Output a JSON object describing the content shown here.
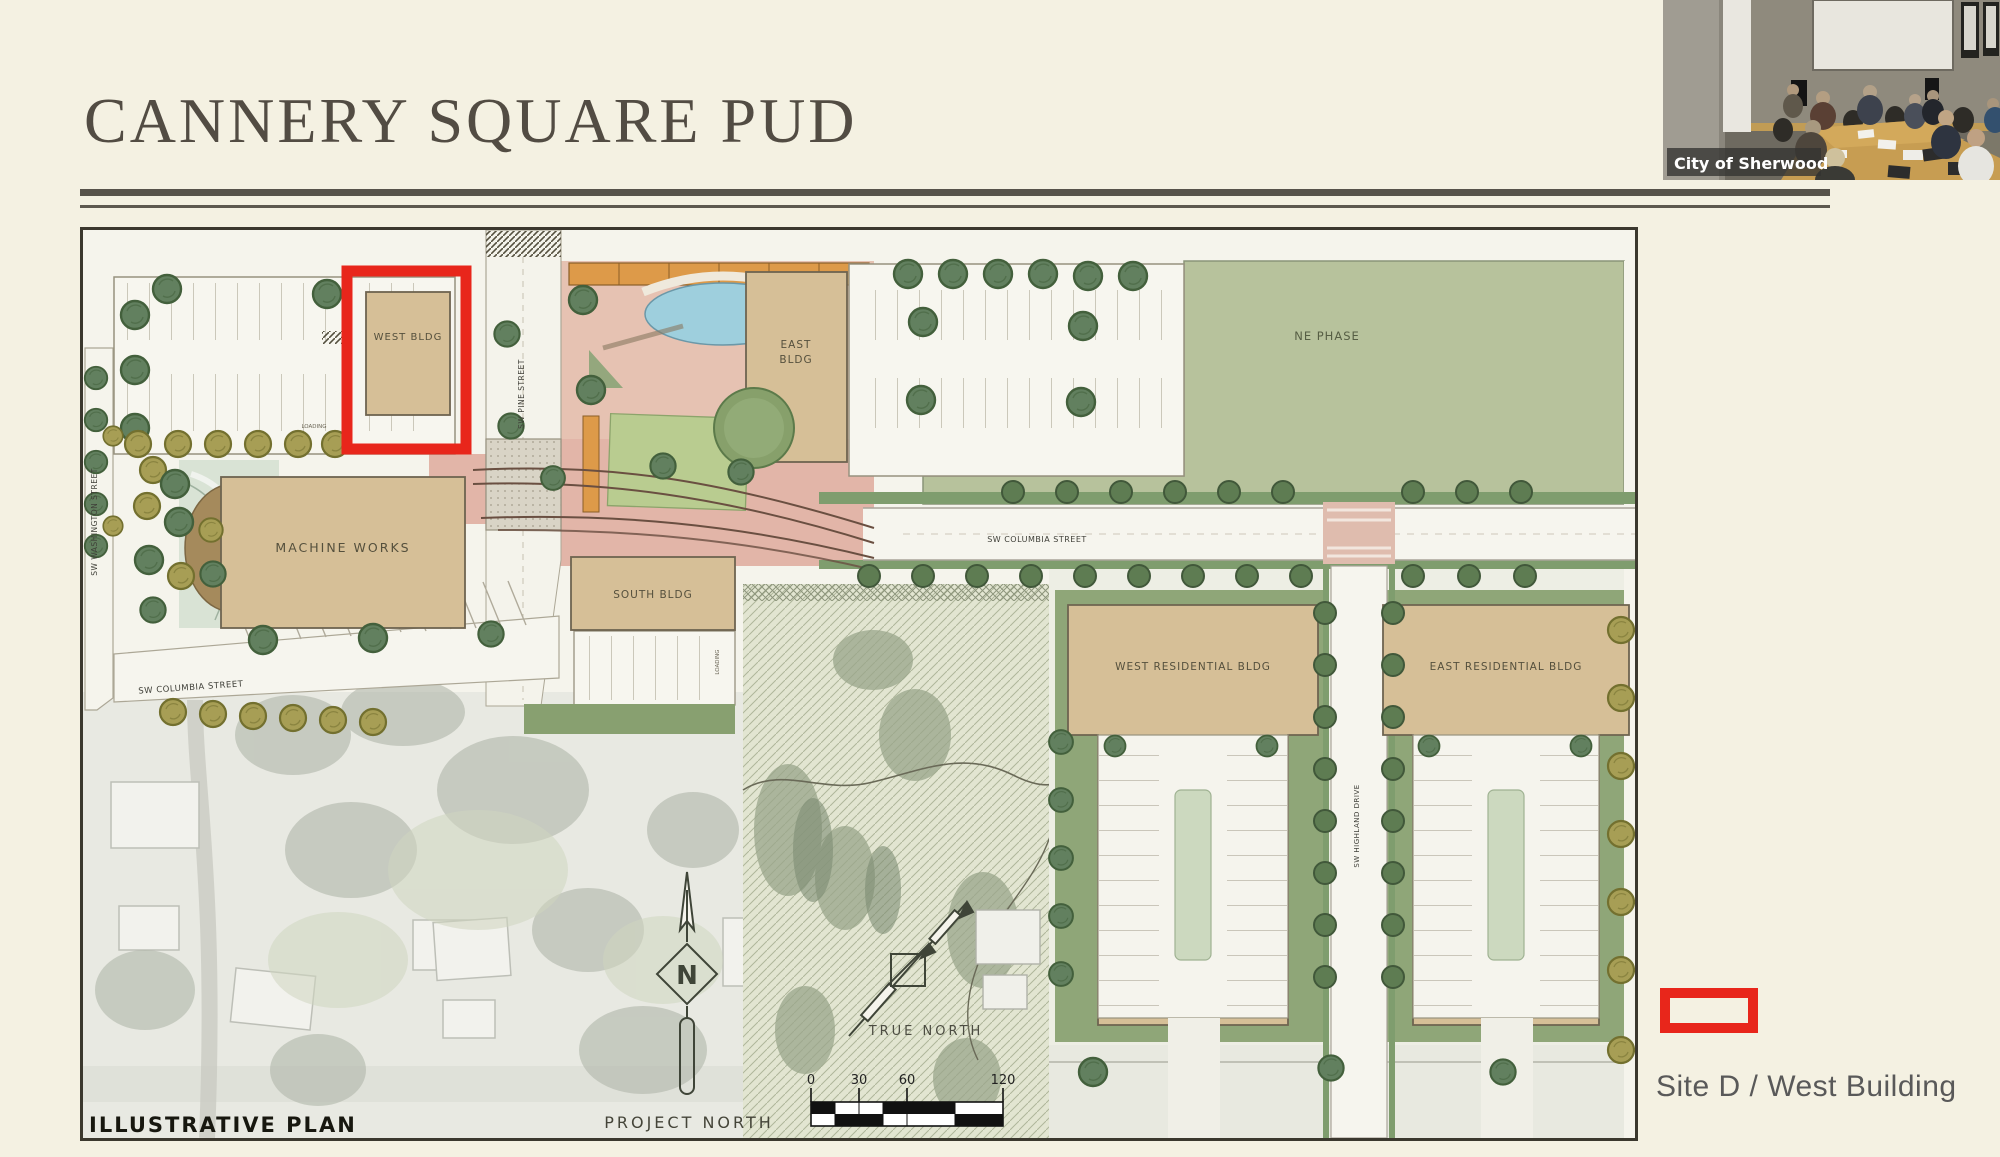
{
  "slide": {
    "title": "CANNERY SQUARE PUD"
  },
  "webcam": {
    "label": "City of Sherwood"
  },
  "callout": {
    "label": "Site D / West Building"
  },
  "plan": {
    "title": "ILLUSTRATIVE PLAN",
    "labels": {
      "west_bldg": "WEST BLDG",
      "east_bldg_line1": "EAST",
      "east_bldg_line2": "BLDG",
      "ne_phase": "NE PHASE",
      "machine_works": "MACHINE WORKS",
      "south_bldg": "SOUTH BLDG",
      "west_residential": "WEST RESIDENTIAL BLDG",
      "east_residential": "EAST RESIDENTIAL BLDG",
      "sw_columbia_left": "SW  COLUMBIA  STREET",
      "sw_columbia_right": "SW  COLUMBIA  STREET",
      "sw_pine": "SW  PINE  STREET",
      "sw_washington": "SW  WASHINGTON  STREET",
      "sw_highland": "SW  HIGHLAND  DRIVE",
      "loading_west": "LOADING",
      "loading_south": "LOADING"
    },
    "compass": {
      "north_letter": "N",
      "true_north": "TRUE  NORTH",
      "project_north": "PROJECT  NORTH"
    },
    "scale_bar": {
      "ticks": [
        "0",
        "30",
        "60",
        "120"
      ]
    },
    "colors": {
      "highlight_red": "#e8261b",
      "building_tan": "#d6bf97",
      "lawn_green": "#b7c29c",
      "plaza_pink": "#e6c2b2",
      "pool_blue": "#9ecfdd",
      "tree_green": "#62805f",
      "tree_olive": "#a79e55"
    }
  }
}
